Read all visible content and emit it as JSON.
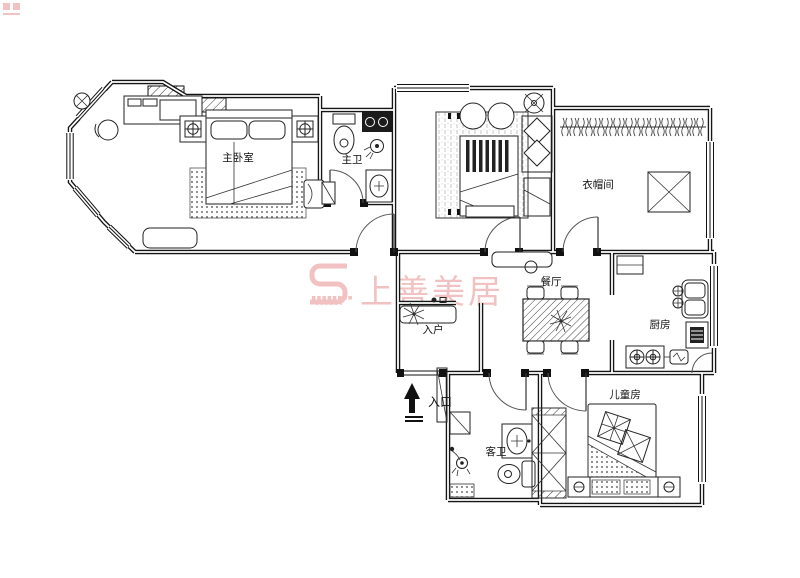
{
  "title": "apartment-floor-plan",
  "colors": {
    "line": "#111111",
    "background": "#ffffff",
    "watermark_pink": "#efb2b2"
  },
  "rooms": {
    "master_bedroom": {
      "label": "主卧室"
    },
    "master_bath": {
      "label": "主卫"
    },
    "cloakroom": {
      "label": "衣帽间"
    },
    "dining": {
      "label": "餐厅"
    },
    "kitchen": {
      "label": "厨房"
    },
    "children_room": {
      "label": "儿童房"
    },
    "guest_bath": {
      "label": "客卫"
    },
    "entry_hall": {
      "label": "入户"
    },
    "entrance": {
      "label": "入口"
    }
  },
  "watermark": {
    "text": "上善美居"
  }
}
